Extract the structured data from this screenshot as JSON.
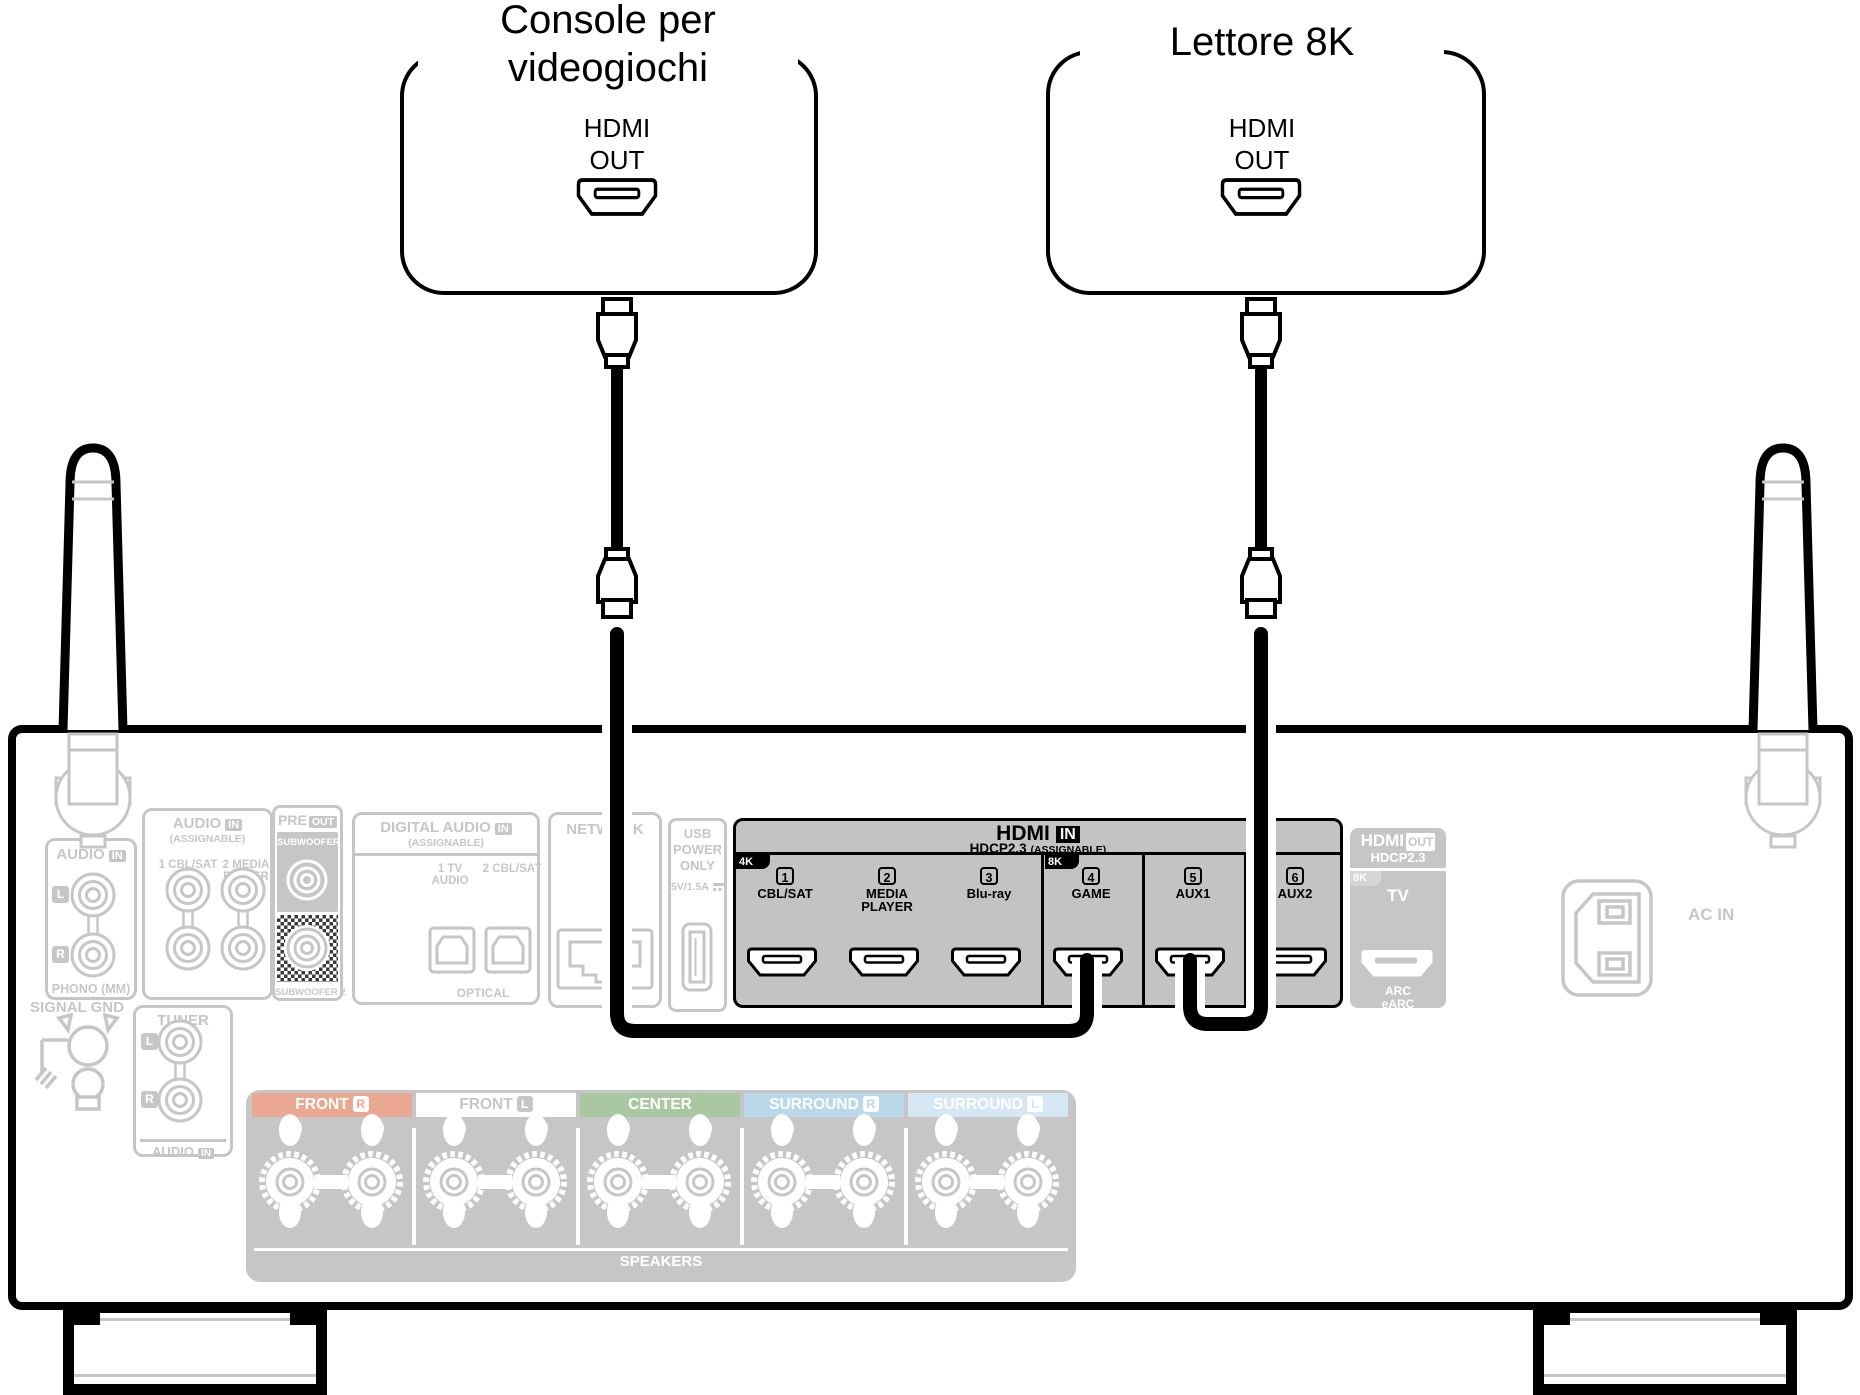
{
  "devices": {
    "console": {
      "title_line1": "Console per",
      "title_line2": "videogiochi",
      "port_line1": "HDMI",
      "port_line2": "OUT"
    },
    "player": {
      "title": "Lettore 8K",
      "port_line1": "HDMI",
      "port_line2": "OUT"
    }
  },
  "receiver": {
    "phono": {
      "header": "AUDIO",
      "header_badge": "IN",
      "l": "L",
      "r": "R",
      "caption": "PHONO (MM)"
    },
    "signal_gnd": {
      "label": "SIGNAL GND"
    },
    "audio_assign": {
      "header": "AUDIO",
      "header_badge": "IN",
      "sub": "(ASSIGNABLE)",
      "col1": "1 CBL/SAT",
      "col2": "2 MEDIA",
      "col2b": "PLAYER"
    },
    "tuner": {
      "header": "TUNER",
      "l": "L",
      "r": "R",
      "footer": "AUDIO",
      "footer_badge": "IN"
    },
    "pre_out": {
      "header": "PRE",
      "header_badge": "OUT",
      "sub1": "SUBWOOFER 1",
      "sub2": "SUBWOOFER 2"
    },
    "digital": {
      "header": "DIGITAL AUDIO",
      "header_badge": "IN",
      "sub": "(ASSIGNABLE)",
      "opt1a": "1  TV",
      "opt1b": "AUDIO",
      "opt2": "2 CBL/SAT",
      "caption": "OPTICAL"
    },
    "network": {
      "header": "NETWORK"
    },
    "usb": {
      "line1": "USB",
      "line2": "POWER",
      "line3": "ONLY",
      "rating": "5V/1.5A"
    },
    "hdmi_in": {
      "title": "HDMI",
      "title_badge": "IN",
      "sub1": "HDCP2.3",
      "sub2": "(ASSIGNABLE)",
      "tab_4k": "4K",
      "tab_8k": "8K",
      "ports": [
        {
          "num": "1",
          "label": "CBL/SAT"
        },
        {
          "num": "2",
          "label": "MEDIA",
          "label2": "PLAYER"
        },
        {
          "num": "3",
          "label": "Blu-ray"
        },
        {
          "num": "4",
          "label": "GAME"
        },
        {
          "num": "5",
          "label": "AUX1"
        },
        {
          "num": "6",
          "label": "AUX2"
        }
      ]
    },
    "hdmi_out": {
      "title": "HDMI",
      "title_badge": "OUT",
      "sub": "HDCP2.3",
      "tab_8k": "8K",
      "tv": "TV",
      "arc": "ARC",
      "earc": "eARC"
    },
    "ac_in": {
      "label": "AC IN"
    },
    "speakers": {
      "groups": [
        {
          "label": "FRONT",
          "side": "R"
        },
        {
          "label": "FRONT",
          "side": "L"
        },
        {
          "label": "CENTER"
        },
        {
          "label": "SURROUND",
          "side": "R"
        },
        {
          "label": "SURROUND",
          "side": "L"
        }
      ],
      "plus": "+",
      "minus": "−",
      "footer": "SPEAKERS"
    }
  },
  "colors": {
    "cable": "#000000",
    "highlight_section_bg": "#c3c3c3",
    "faded_gray": "#c6c6c6",
    "front_r_band": "#eaa893",
    "front_l_band": "#ffffff",
    "center_band": "#a9c7a1",
    "surround_r_band": "#b9d9ea",
    "surround_l_band": "#d4e7f2"
  }
}
